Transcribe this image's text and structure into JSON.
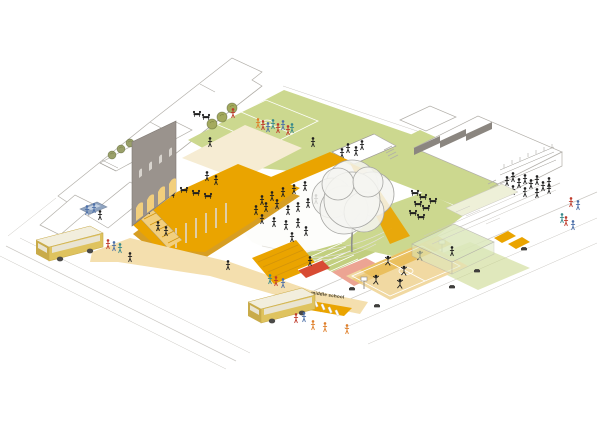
{
  "meta": {
    "image_type": "architectural axonometric site diagram",
    "description": "Aerial axonometric illustration of a middle-school campus block: raised amber plaza with arched grey facade wall, upper lawn sports field with topiary shrubs, sunken courtyard, large sketch tree over a white gathering plaza, basketball court, glass pavilion, roof terraces with crowds, amphitheater stair with red slide down to the street, two yellow school buses and pedestrians on surrounding streets."
  },
  "labels": {
    "school_sign": "middle school"
  },
  "counts": {
    "school_buses": 2,
    "cars": 1,
    "large_trees": 1,
    "lawn_shrubs": 3,
    "rooftop_trees": 3,
    "basketball_hoops": 2,
    "facade_arches": 4,
    "street_benches": 5,
    "crosswalk_stripes": 5,
    "approx_people_visible": 85
  },
  "palette": {
    "white": "#ffffff",
    "line_light": "#cbc8c3",
    "line_mid": "#b2afa9",
    "lawn": "#ccd88f",
    "lawn_dark": "#c2cf7f",
    "cream": "#f6ecd3",
    "amber": "#eaa400",
    "amber_light": "#f2cf7d",
    "amber_pale": "#f4dfae",
    "amber_deep": "#d3940a",
    "facade_gray": "#9a938d",
    "parapet_gray": "#8b8680",
    "tree_line": "#a6a6a3",
    "tree_fill": "#f4f4f1",
    "trunk": "#8f8f8c",
    "shrub_olive": "#a4aa5e",
    "shrub_gray": "#9aa06a",
    "red_accent": "#d84b33",
    "salmon": "#eca493",
    "glass_green": "#dce8bd",
    "pale_awning": "#eef0d8",
    "court_tan": "#f1d9a2",
    "court_amber": "#e9bc55",
    "bus_yellow": "#dfc35f",
    "bus_roof": "#f2eedd",
    "bus_window": "#e9e4d2",
    "bus_shadow": "#c9ab4a",
    "wheel_dark": "#4b4a48",
    "figure_black": "#1f1f1f",
    "fig_red": "#bf3a2b",
    "fig_blue": "#4c6fa8",
    "fig_teal": "#37898b",
    "fig_orange": "#df7f2a",
    "car_blue": "#8ea3c0",
    "car_glass": "#c6d2e2",
    "sign_dark": "#3c3420",
    "bench_dark": "#3f3e3c"
  },
  "scene": {
    "elements": [
      {
        "name": "row-buildings",
        "description": "white outlined rowhouse volumes along upper-left street"
      },
      {
        "name": "rooftop-terrace",
        "description": "roof terrace with three small trees, long table and two seated groups"
      },
      {
        "name": "gray-facade-wall",
        "description": "tall grey heritage wall with four glowing arched openings and four small arched windows"
      },
      {
        "name": "amber-deck",
        "description": "raised bright amber plaza deck on thin columns with rows of cafe tables"
      },
      {
        "name": "deck-stair",
        "description": "amber switchback stair from deck to street walkway"
      },
      {
        "name": "upper-lawn-field",
        "description": "green lawn with white sports-field markings and three clipped shrubs"
      },
      {
        "name": "cream-terrace",
        "description": "cream colored terrace between lawn and deck"
      },
      {
        "name": "sunken-courtyard",
        "description": "sunken white courtyard with railings, stair and four figures"
      },
      {
        "name": "central-plaza",
        "description": "white gathering plaza with ground contour lines and many standing figures"
      },
      {
        "name": "main-tree",
        "description": "large grey sketch-style deciduous tree"
      },
      {
        "name": "amphitheater-stair",
        "description": "amber seating steps descending to street level"
      },
      {
        "name": "red-slide",
        "description": "red slide beside the amphitheater steps"
      },
      {
        "name": "school-sign",
        "description": "tiny dark 'middle school' lettering on the walkway edge"
      },
      {
        "name": "basketball-court",
        "description": "striped tan and amber court with white lines, two hoops, five players"
      },
      {
        "name": "salmon-court",
        "description": "salmon colored play surface with two table-tennis style tables"
      },
      {
        "name": "glass-pavilion",
        "description": "translucent green glazed pavilion box"
      },
      {
        "name": "right-building",
        "description": "white school building with stepped grey parapet, roof terrace crowd and striped awning"
      },
      {
        "name": "school-bus-1",
        "description": "yellow school bus parked on left street"
      },
      {
        "name": "school-bus-2",
        "description": "yellow school bus parked on lower street near crosswalk"
      },
      {
        "name": "car",
        "description": "small blue car at upper-left drop-off"
      },
      {
        "name": "street-benches",
        "description": "dark benches spaced along lower-right street"
      },
      {
        "name": "pedestrians",
        "description": "black silhouettes on plazas, colorful figures on field and sidewalks"
      }
    ]
  },
  "sprites": {
    "plaza_figures": {
      "glyph": "person",
      "color": "figure_black",
      "points": [
        [
          262,
          201
        ],
        [
          272,
          197
        ],
        [
          283,
          193
        ],
        [
          294,
          190
        ],
        [
          305,
          187
        ],
        [
          256,
          211
        ],
        [
          266,
          208
        ],
        [
          277,
          205
        ],
        [
          288,
          211
        ],
        [
          298,
          208
        ],
        [
          308,
          204
        ],
        [
          262,
          220
        ],
        [
          274,
          223
        ],
        [
          286,
          226
        ],
        [
          298,
          224
        ],
        [
          316,
          200
        ],
        [
          306,
          232
        ],
        [
          292,
          238
        ]
      ]
    },
    "deck_figures": {
      "glyph": "person",
      "color": "figure_black",
      "points": [
        [
          207,
          177
        ],
        [
          216,
          181
        ],
        [
          210,
          143
        ],
        [
          313,
          143
        ]
      ]
    },
    "stair_sitters": {
      "glyph": "person",
      "color": "figure_black",
      "points": [
        [
          134,
          206
        ],
        [
          141,
          208
        ],
        [
          148,
          210
        ],
        [
          158,
          227
        ],
        [
          166,
          232
        ]
      ]
    },
    "walk_figures": {
      "glyph": "person",
      "color": "figure_black",
      "points": [
        [
          228,
          266
        ],
        [
          130,
          258
        ],
        [
          100,
          216
        ],
        [
          310,
          262
        ]
      ]
    },
    "roof_terrace_figures": {
      "glyph": "person",
      "color": "figure_black",
      "points": [
        [
          507,
          182
        ],
        [
          513,
          178
        ],
        [
          519,
          184
        ],
        [
          525,
          180
        ],
        [
          531,
          185
        ],
        [
          537,
          181
        ],
        [
          543,
          187
        ],
        [
          549,
          183
        ],
        [
          513,
          191
        ],
        [
          525,
          193
        ],
        [
          537,
          194
        ],
        [
          549,
          190
        ]
      ]
    },
    "courtyard_figures": {
      "glyph": "person",
      "color": "figure_black",
      "points": [
        [
          348,
          149
        ],
        [
          356,
          152
        ],
        [
          342,
          154
        ],
        [
          362,
          146
        ]
      ]
    },
    "court_players": {
      "glyph": "player",
      "color": "figure_black",
      "points": [
        [
          388,
          262
        ],
        [
          404,
          272
        ],
        [
          376,
          281
        ],
        [
          420,
          257
        ],
        [
          400,
          285
        ]
      ]
    },
    "deck_tables": {
      "glyph": "table2",
      "color": "figure_black",
      "points": [
        [
          147,
          189
        ],
        [
          159,
          192
        ],
        [
          171,
          195
        ],
        [
          184,
          190
        ],
        [
          196,
          193
        ],
        [
          208,
          196
        ]
      ]
    },
    "rooftop_tables": {
      "glyph": "table2",
      "color": "figure_black",
      "points": [
        [
          197,
          114
        ],
        [
          206,
          117
        ]
      ]
    },
    "right_terrace_tables": {
      "glyph": "table2",
      "color": "figure_black",
      "points": [
        [
          415,
          193
        ],
        [
          423,
          197
        ],
        [
          418,
          204
        ],
        [
          426,
          208
        ],
        [
          413,
          213
        ],
        [
          421,
          217
        ],
        [
          433,
          201
        ]
      ]
    },
    "street_benches": {
      "glyph": "bench",
      "color": "bench_dark",
      "points": [
        [
          352,
          289
        ],
        [
          377,
          306
        ],
        [
          452,
          287
        ],
        [
          477,
          271
        ],
        [
          524,
          249
        ]
      ]
    },
    "lawn_shrubs": {
      "glyph": "shrub",
      "color": "shrub_olive",
      "points": [
        [
          232,
          108
        ],
        [
          222,
          117
        ],
        [
          212,
          124
        ]
      ]
    },
    "roof_trees": {
      "glyph": "shrub",
      "color": "shrub_gray",
      "scale": 0.8,
      "points": [
        [
          112,
          155
        ],
        [
          121,
          149
        ],
        [
          130,
          143
        ]
      ]
    },
    "red_figures": {
      "glyph": "person",
      "color": "fig_red",
      "points": [
        [
          263,
          126
        ],
        [
          278,
          129
        ],
        [
          288,
          131
        ],
        [
          233,
          114
        ],
        [
          571,
          203
        ],
        [
          566,
          222
        ],
        [
          276,
          282
        ],
        [
          108,
          245
        ],
        [
          296,
          319
        ]
      ]
    },
    "blue_figures": {
      "glyph": "person",
      "color": "fig_blue",
      "points": [
        [
          268,
          128
        ],
        [
          283,
          126
        ],
        [
          573,
          226
        ],
        [
          283,
          284
        ],
        [
          114,
          247
        ],
        [
          87,
          211
        ],
        [
          94,
          209
        ],
        [
          304,
          318
        ],
        [
          578,
          206
        ]
      ]
    },
    "teal_figures": {
      "glyph": "person",
      "color": "fig_teal",
      "points": [
        [
          273,
          125
        ],
        [
          292,
          129
        ],
        [
          562,
          219
        ],
        [
          270,
          280
        ],
        [
          120,
          249
        ]
      ]
    },
    "orange_figures": {
      "glyph": "person",
      "color": "fig_orange",
      "points": [
        [
          313,
          326
        ],
        [
          325,
          328
        ],
        [
          347,
          330
        ],
        [
          258,
          124
        ]
      ]
    }
  }
}
